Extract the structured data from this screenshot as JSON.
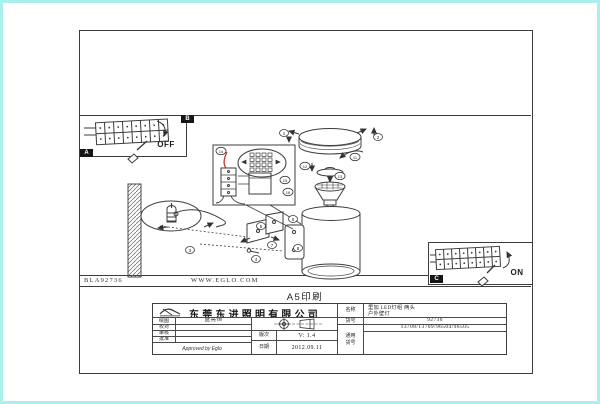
{
  "frame": {
    "box_a_label": "A",
    "box_b_label": "B",
    "box_c_label": "C"
  },
  "switch_labels": {
    "off": "OFF",
    "on": "ON"
  },
  "callouts": {
    "n1": "1",
    "n2": "2",
    "n3": "3",
    "n4": "4",
    "n5": "5",
    "n6": "6",
    "n7": "7",
    "n8": "8",
    "n11": "11",
    "n12": "12",
    "n13": "13",
    "n14": "14",
    "n15": "15",
    "n16": "16"
  },
  "footer": {
    "doc_code": "BLA92736",
    "website": "WWW.EGLO.COM",
    "print_note": "A5印刷"
  },
  "title_block": {
    "company": "东莞东进照明有限公司",
    "drawn_label": "绘图",
    "drawn_value": "盛亮恒",
    "checked_label": "校对",
    "checked_value": "",
    "reviewed_label": "审核",
    "reviewed_value": "",
    "approve_label": "批准",
    "approve_value": "",
    "approved_note": "Approved by Eglo",
    "version_label": "版次",
    "version_value": "V: 1.4",
    "date_label": "日期",
    "date_value": "2012.09.11",
    "name_label": "名称",
    "name_value_line1": "里加 LED灯组 两头",
    "name_value_line2": "户外壁灯",
    "item_label": "货号",
    "item_value": "92736",
    "common_label_line1": "通用",
    "common_label_line2": "货号",
    "common_value": "13708/13709/96504/96505"
  },
  "colors": {
    "edge": "#a9efec",
    "line": "#3c3c3c",
    "accent_red": "#c03a2b"
  }
}
